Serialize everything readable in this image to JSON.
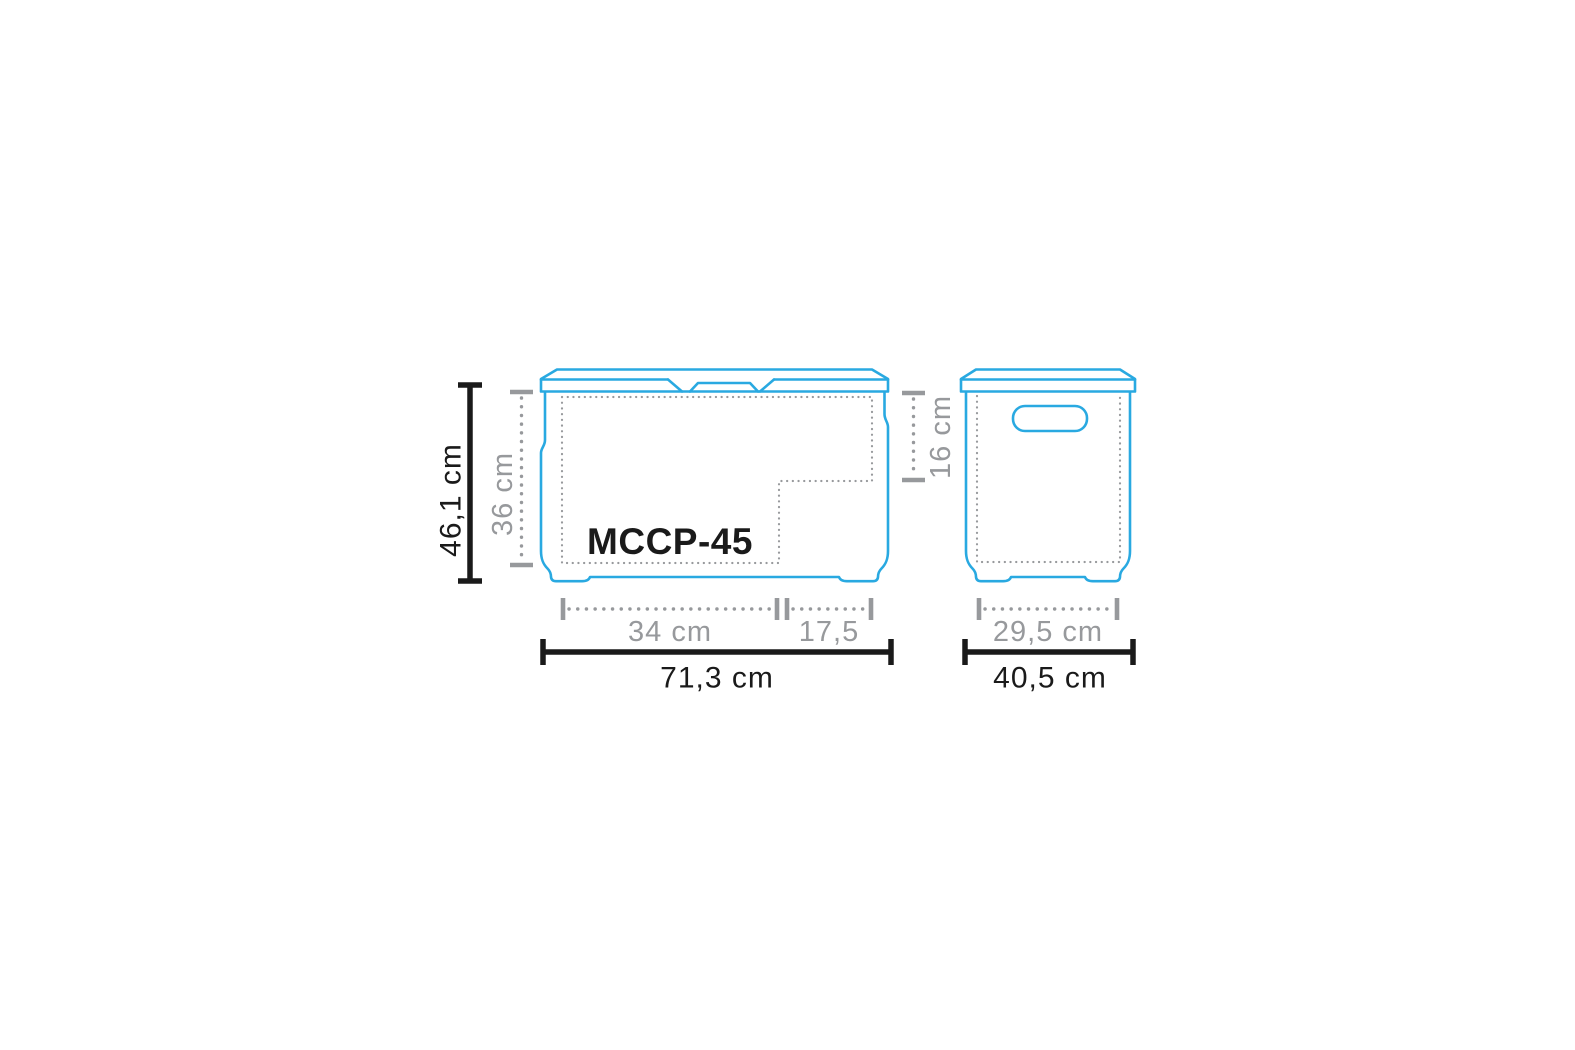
{
  "colors": {
    "outline": "#29a9e1",
    "dim_primary": "#1a1a1a",
    "dim_secondary": "#97999c",
    "background": "#ffffff"
  },
  "model_label": "MCCP-45",
  "dimensions": {
    "overall_height": "46,1 cm",
    "inner_height": "36 cm",
    "step_height": "16 cm",
    "inner_width": "34 cm",
    "step_width": "17,5",
    "overall_width": "71,3 cm",
    "inner_depth": "29,5 cm",
    "overall_depth": "40,5 cm"
  }
}
